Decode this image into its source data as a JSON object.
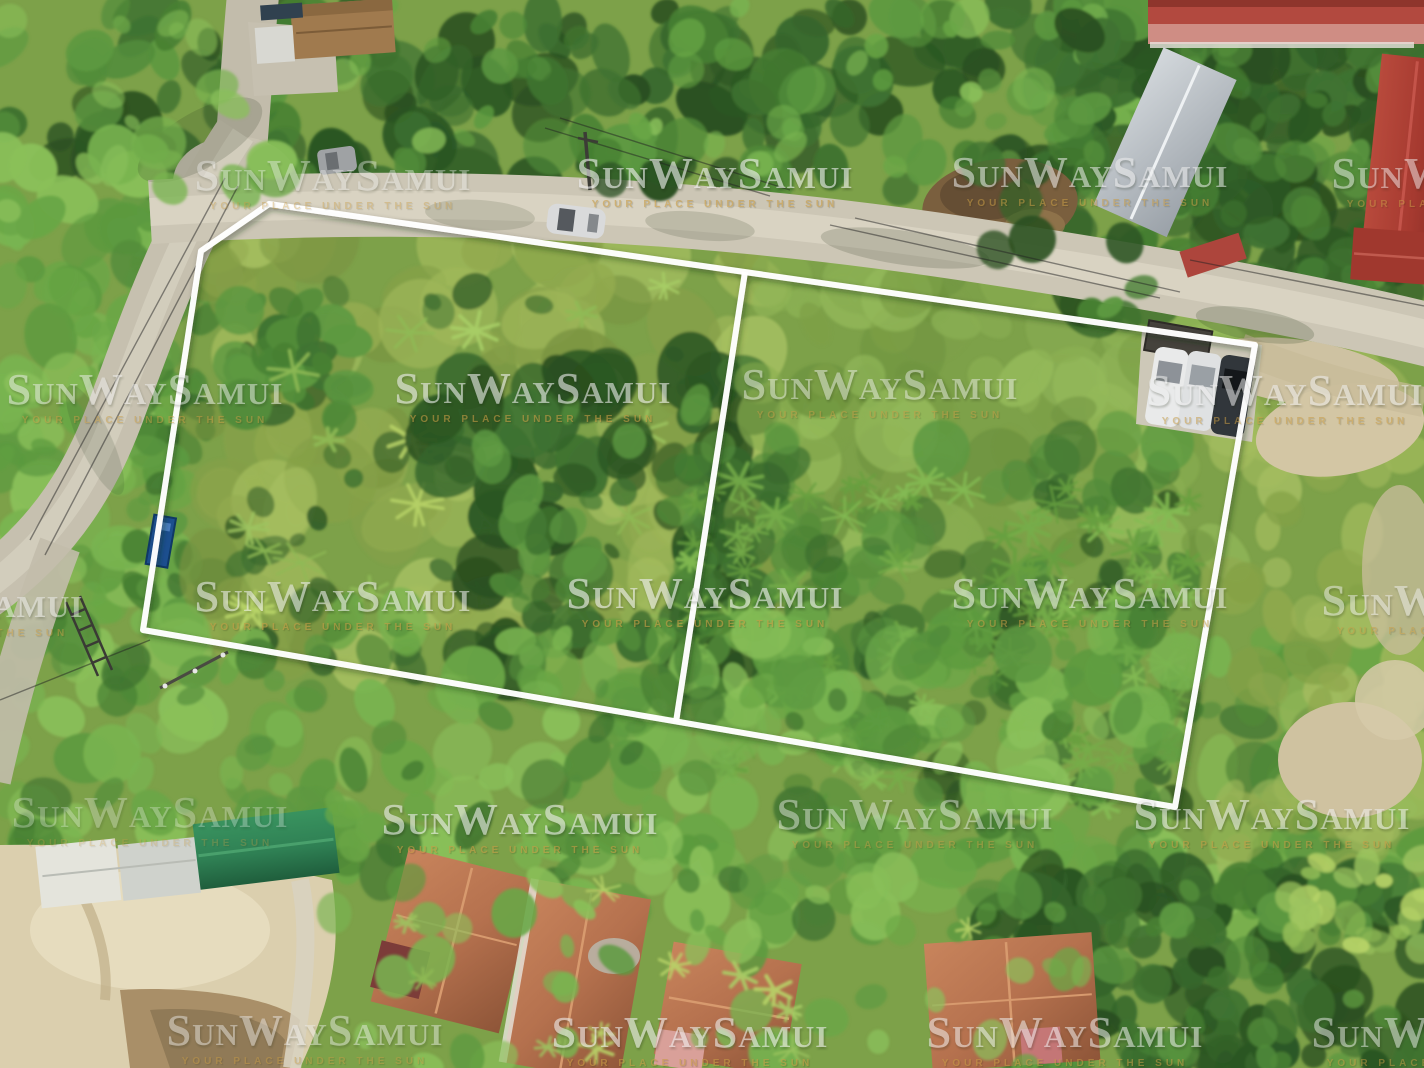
{
  "watermark": {
    "brand": "SunWaySamui",
    "tagline": "YOUR PLACE UNDER THE SUN",
    "brand_color": "#ededed",
    "tagline_color": "#c79c45",
    "instances": [
      {
        "x": 333,
        "y": 183,
        "o": 0.4
      },
      {
        "x": 715,
        "y": 181,
        "o": 0.62
      },
      {
        "x": 1090,
        "y": 180,
        "o": 0.55
      },
      {
        "x": 1470,
        "y": 181,
        "o": 0.5
      },
      {
        "x": 145,
        "y": 397,
        "o": 0.5
      },
      {
        "x": 533,
        "y": 396,
        "o": 0.6
      },
      {
        "x": 880,
        "y": 392,
        "o": 0.48
      },
      {
        "x": 1285,
        "y": 398,
        "o": 0.55
      },
      {
        "x": -55,
        "y": 610,
        "o": 0.5
      },
      {
        "x": 333,
        "y": 604,
        "o": 0.58
      },
      {
        "x": 705,
        "y": 601,
        "o": 0.62
      },
      {
        "x": 1090,
        "y": 601,
        "o": 0.55
      },
      {
        "x": 1460,
        "y": 608,
        "o": 0.5
      },
      {
        "x": 150,
        "y": 820,
        "o": 0.3
      },
      {
        "x": 520,
        "y": 827,
        "o": 0.6
      },
      {
        "x": 915,
        "y": 822,
        "o": 0.45
      },
      {
        "x": 1272,
        "y": 822,
        "o": 0.56
      },
      {
        "x": 305,
        "y": 1038,
        "o": 0.45
      },
      {
        "x": 690,
        "y": 1040,
        "o": 0.6
      },
      {
        "x": 1065,
        "y": 1040,
        "o": 0.55
      },
      {
        "x": 1450,
        "y": 1040,
        "o": 0.5
      }
    ]
  },
  "scene": {
    "palette": {
      "plot_outline": "#ffffff",
      "road_concrete": "#ccc6b5",
      "sand": "#dbcfae",
      "mud_water": "#a98f68",
      "grass_plot": "#93ab50",
      "forest_dark": "#2c5724",
      "forest_bright": "#79b450",
      "villa_terracotta": "#b5714e",
      "green_roof": "#2f8054",
      "red_roof": "#a63a30",
      "pink_building": "#cf8d84",
      "car_dark": "#31363b",
      "car_white": "#e9eaea",
      "sign_blue": "#1c4f8f"
    }
  }
}
